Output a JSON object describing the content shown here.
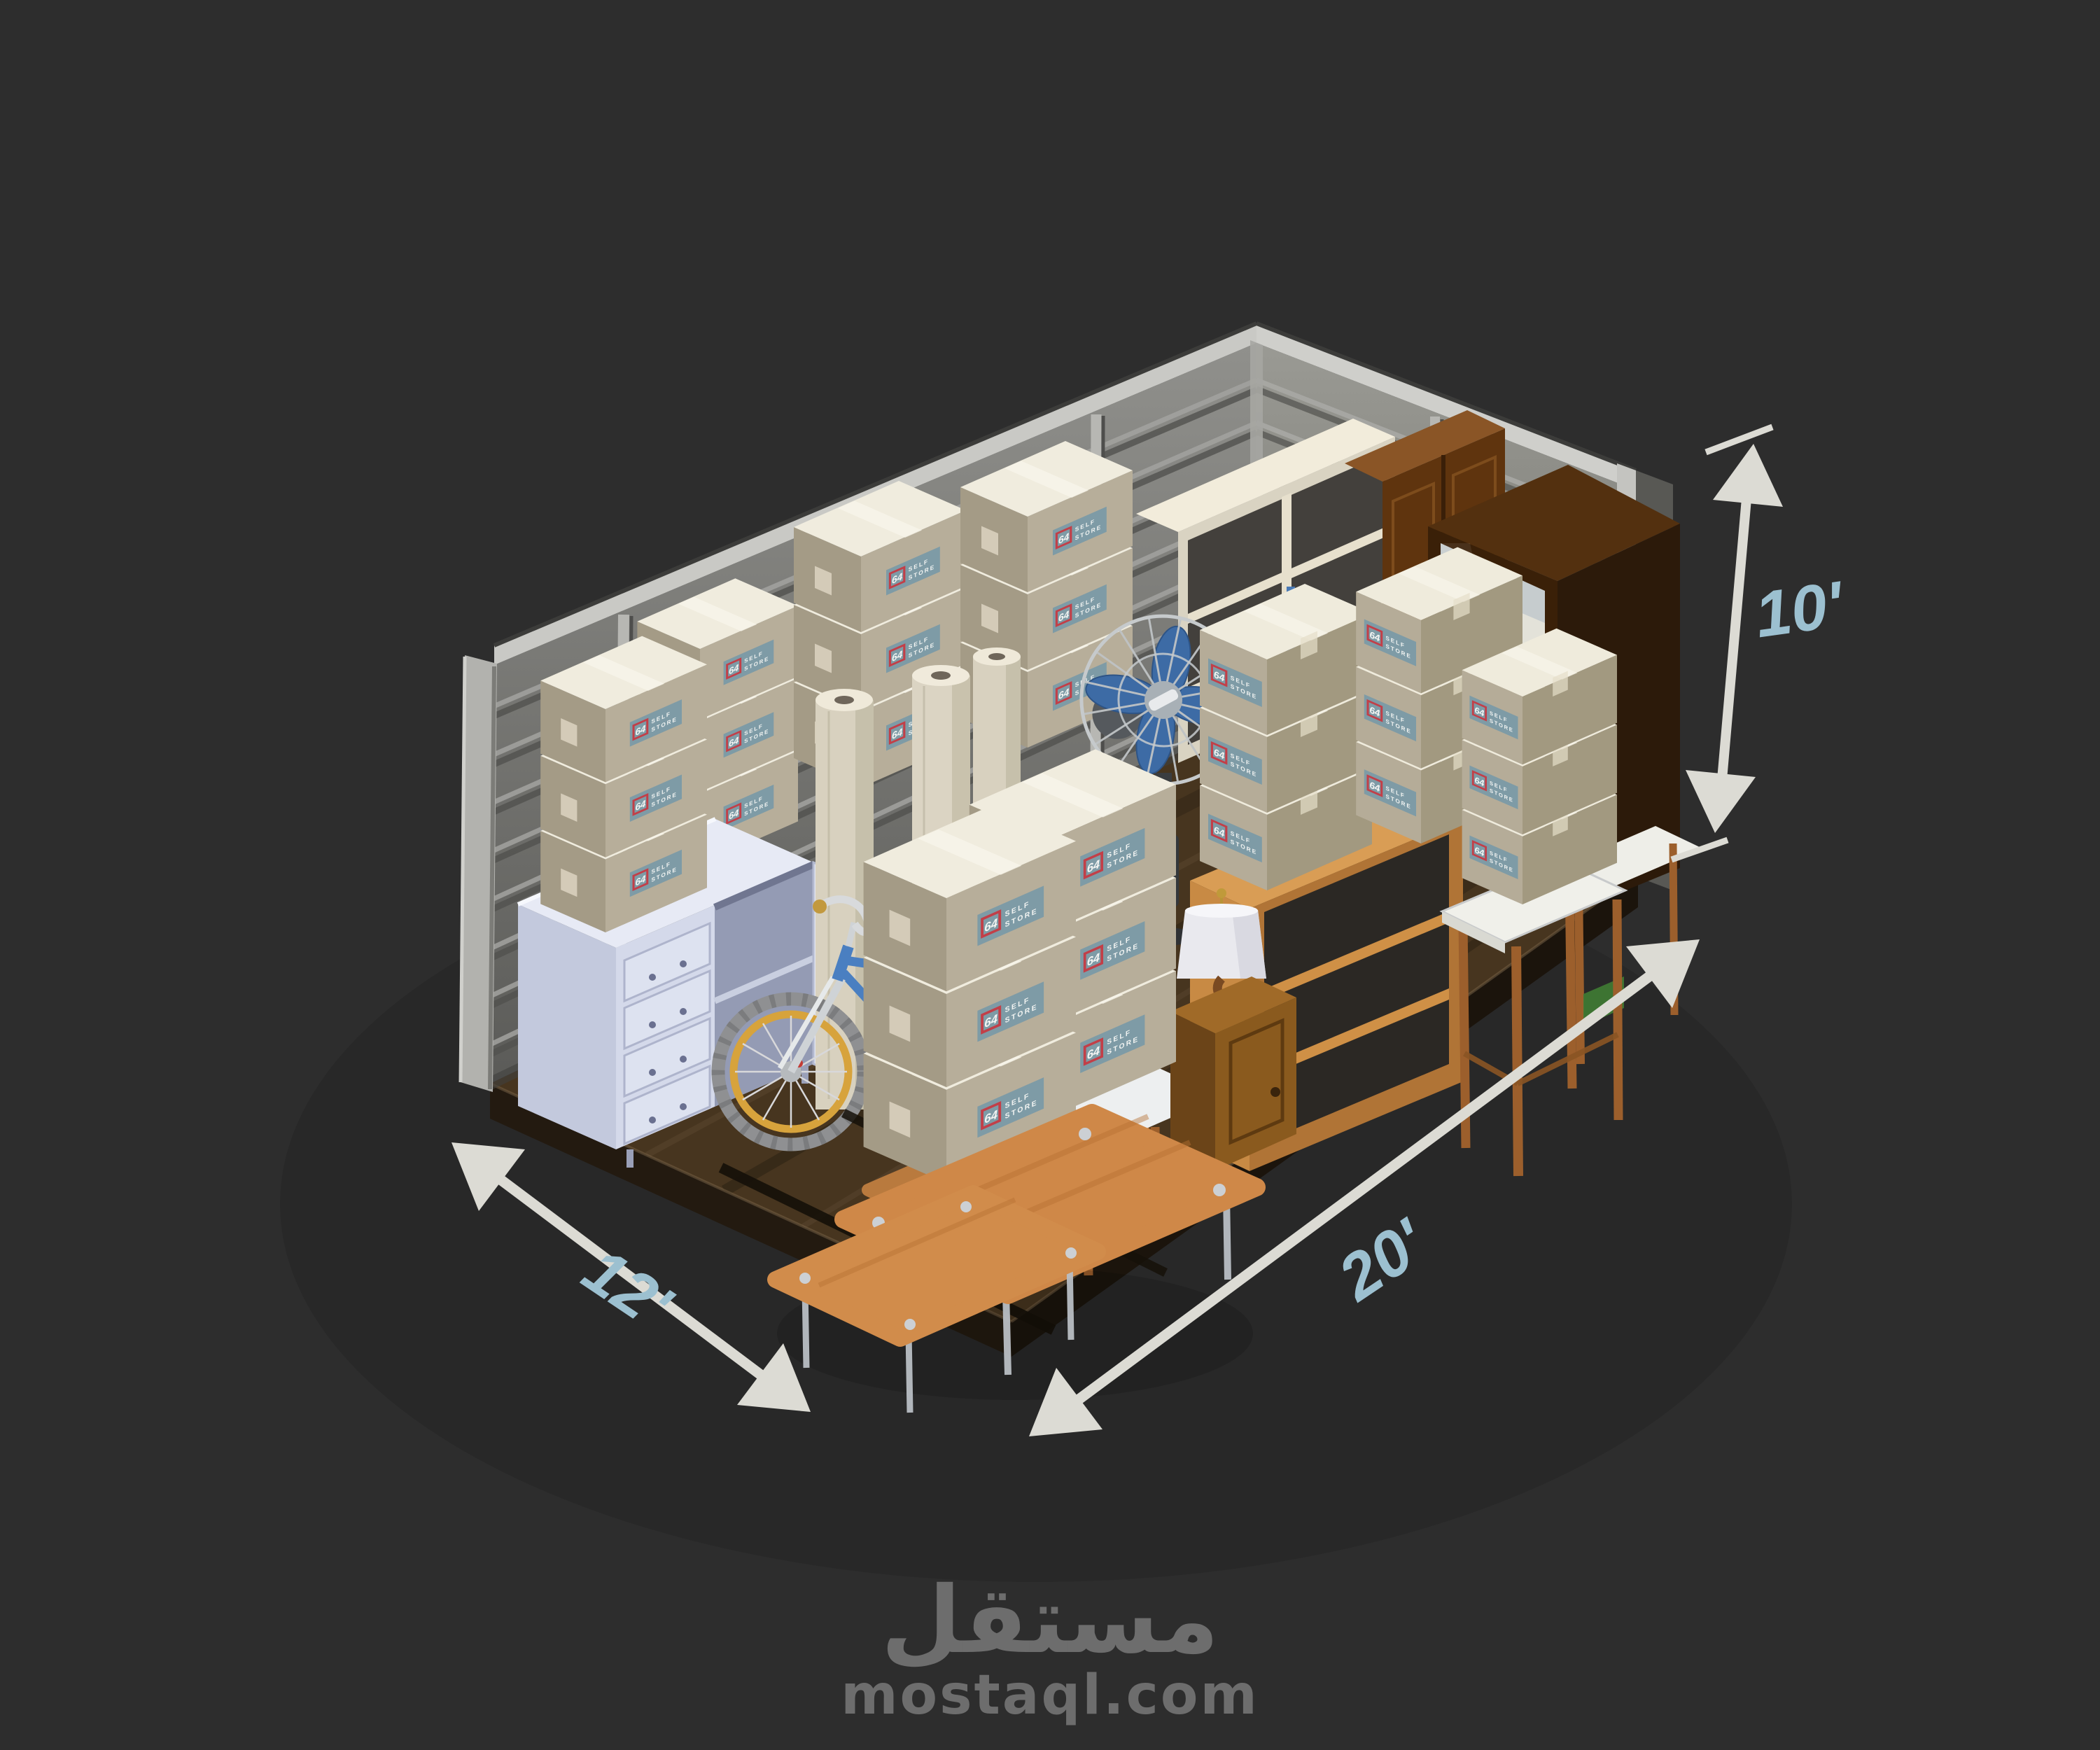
{
  "scene": {
    "description": "3D isometric render of a packed self-storage unit with corner metal walls and wood floor",
    "unit_size": "12' x 20' x 10'",
    "items": [
      "corrugated metal walls",
      "dark wood floor platform",
      "cardboard moving boxes",
      "white dresser with drawers",
      "child bicycle",
      "rolled carpets",
      "blue pedestal fan",
      "cream shelving unit",
      "brown cabinet",
      "dark wardrobe with mirror",
      "oak bookshelf",
      "wooden stools",
      "nightstand with lamp",
      "orange nesting coffee tables",
      "packing straps"
    ]
  },
  "dimensions": {
    "height": "10'",
    "length": "20'",
    "width": "12'"
  },
  "box_label": {
    "number": "64",
    "line1": "SELF",
    "line2": "STORE"
  },
  "watermark": {
    "logo": "مستقل",
    "site": "mostaql.com"
  },
  "colors": {
    "background": "#2d2d2d",
    "dimension_text": "#9cc0d0",
    "arrow": "#dcdbd4",
    "box_cardboard": "#b5ac98",
    "box_top": "#efebdc",
    "box_label_bg": "#7e9ba6",
    "box_label_red": "#c23f48",
    "wall_metal": "#8c8c88",
    "floor_wood": "#47351f",
    "fan_blue": "#3d6ba5",
    "bike_blue": "#4a7fc1",
    "bike_rim_yellow": "#d7a33c",
    "table_orange": "#cf8848",
    "watermark": "#6d6d6d"
  }
}
